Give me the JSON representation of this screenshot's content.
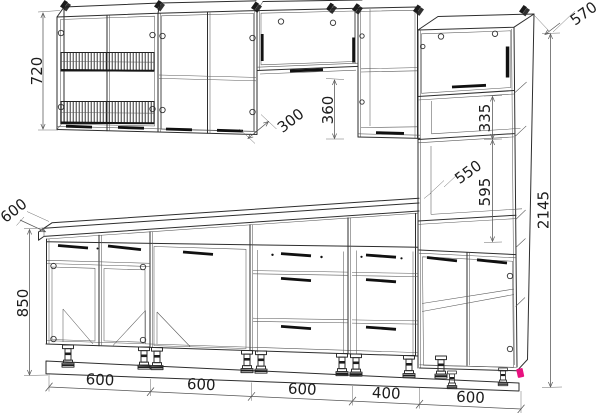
{
  "drawing": {
    "type": "kitchen-cabinet-set-technical-elevation",
    "dims": {
      "wall_cabinet_height": "720",
      "worktop_depth": "600",
      "base_cabinet_height": "850",
      "wall_cabinet_depth": "300",
      "wall_gap_height": "360",
      "tall_cabinet_depth": "570",
      "tall_upper_section": "335",
      "niche_depth": "550",
      "niche_height": "595",
      "total_height": "2145"
    },
    "bottom_widths": [
      "600",
      "600",
      "600",
      "400",
      "600"
    ],
    "colors": {
      "line": "#2e2e2e",
      "dimension": "#555555",
      "accent_marker": "#e8117f"
    }
  }
}
